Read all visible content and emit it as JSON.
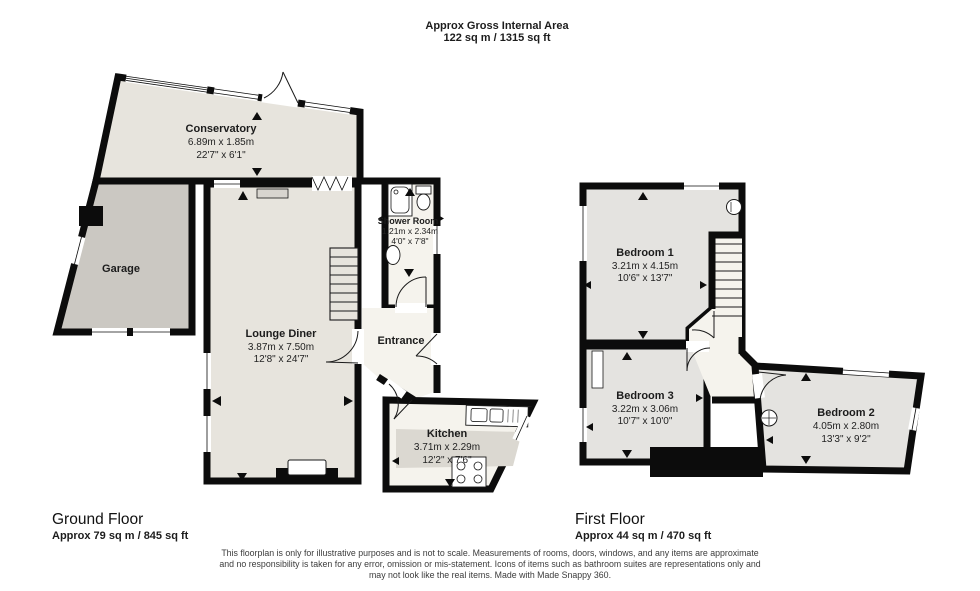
{
  "header": {
    "title": "Approx Gross Internal Area",
    "subtitle": "122 sq m / 1315 sq ft"
  },
  "ground_floor": {
    "label": "Ground Floor",
    "area": "Approx 79 sq m / 845 sq ft",
    "rooms": {
      "conservatory": {
        "name": "Conservatory",
        "metric": "6.89m x 1.85m",
        "imperial": "22'7\" x 6'1\""
      },
      "garage": {
        "name": "Garage"
      },
      "lounge_diner": {
        "name": "Lounge Diner",
        "metric": "3.87m x 7.50m",
        "imperial": "12'8\" x 24'7\""
      },
      "shower_room": {
        "name": "Shower Room",
        "metric": "1.21m x 2.34m",
        "imperial": "4'0\" x 7'8\""
      },
      "entrance": {
        "name": "Entrance"
      },
      "kitchen": {
        "name": "Kitchen",
        "metric": "3.71m x 2.29m",
        "imperial": "12'2\" x 7'6\""
      }
    }
  },
  "first_floor": {
    "label": "First Floor",
    "area": "Approx 44 sq m / 470 sq ft",
    "rooms": {
      "bedroom_1": {
        "name": "Bedroom 1",
        "metric": "3.21m x 4.15m",
        "imperial": "10'6\" x 13'7\""
      },
      "bedroom_3": {
        "name": "Bedroom 3",
        "metric": "3.22m x 3.06m",
        "imperial": "10'7\" x 10'0\""
      },
      "bedroom_2": {
        "name": "Bedroom 2",
        "metric": "4.05m x 2.80m",
        "imperial": "13'3\" x 9'2\""
      }
    }
  },
  "footer": {
    "disclaimer": [
      "This floorplan is only for illustrative purposes and is not to scale. Measurements of rooms, doors, windows, and any items are approximate",
      "and no responsibility is taken for any error, omission or mis-statement. Icons of items such as bathroom suites are representations only and",
      "may not look like the real items. Made with Made Snappy 360."
    ]
  },
  "colors": {
    "wall": "#0c0c0c",
    "floor_main": "#e7e4dd",
    "floor_garage": "#cbc8c2",
    "floor_light": "#f5f3ed",
    "floor_bedroom": "#e4e3e0",
    "floor_island": "#dbd8d1"
  }
}
